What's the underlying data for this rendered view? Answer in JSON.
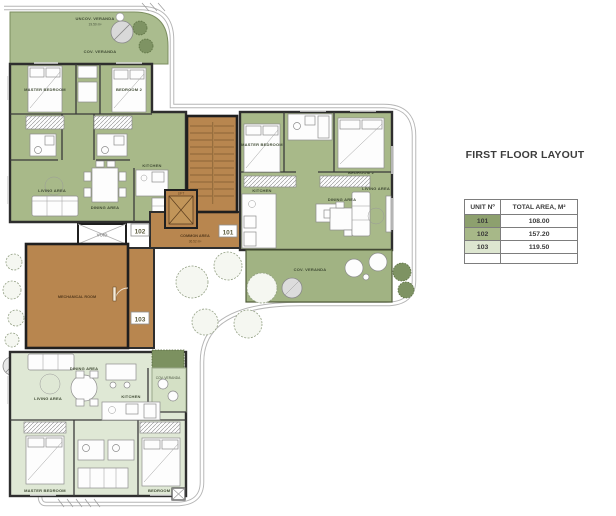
{
  "header": {
    "title": "FIRST FLOOR LAYOUT"
  },
  "table": {
    "col_unit": "UNIT Nº",
    "col_area": "TOTAL AREA, M²",
    "rows": [
      {
        "unit": "101",
        "area": "108.00",
        "color": "#8da06e"
      },
      {
        "unit": "102",
        "area": "157.20",
        "color": "#a7b888"
      },
      {
        "unit": "103",
        "area": "119.50",
        "color": "#dde6d0"
      }
    ]
  },
  "plan": {
    "units": {
      "u101": "101",
      "u102": "102",
      "u103": "103"
    },
    "common": {
      "label": "COMMON AREA",
      "area": "36.52 m²",
      "lift": "LIFT",
      "void": "VOID",
      "mechanical": "MECHANICAL ROOM"
    },
    "unit102": {
      "uncov_veranda": "UNCOV. VERANDA",
      "uncov_area": "19.50 m²",
      "cov_veranda": "COV. VERANDA",
      "master": "MASTER BEDROOM",
      "bedroom2": "BEDROOM 2",
      "living": "LIVING AREA",
      "dining": "DINING AREA",
      "kitchen": "KITCHEN"
    },
    "unit101": {
      "master": "MASTER BEDROOM",
      "bedroom2": "BEDROOM 2",
      "kitchen": "KITCHEN",
      "dining": "DINING AREA",
      "living": "LIVING AREA",
      "cov_veranda": "COV. VERANDA"
    },
    "unit103": {
      "living": "LIVING AREA",
      "dining": "DINING AREA",
      "kitchen": "KITCHEN",
      "master": "MASTER BEDROOM",
      "bedroom2": "BEDROOM 2",
      "cov_veranda": "COV. VERANDA"
    },
    "colors": {
      "sage": "#a8b989",
      "sage_light": "#aabc8e",
      "mint": "#dfe8d5",
      "brown": "#b8864f",
      "wall": "#2e2e2e"
    }
  }
}
